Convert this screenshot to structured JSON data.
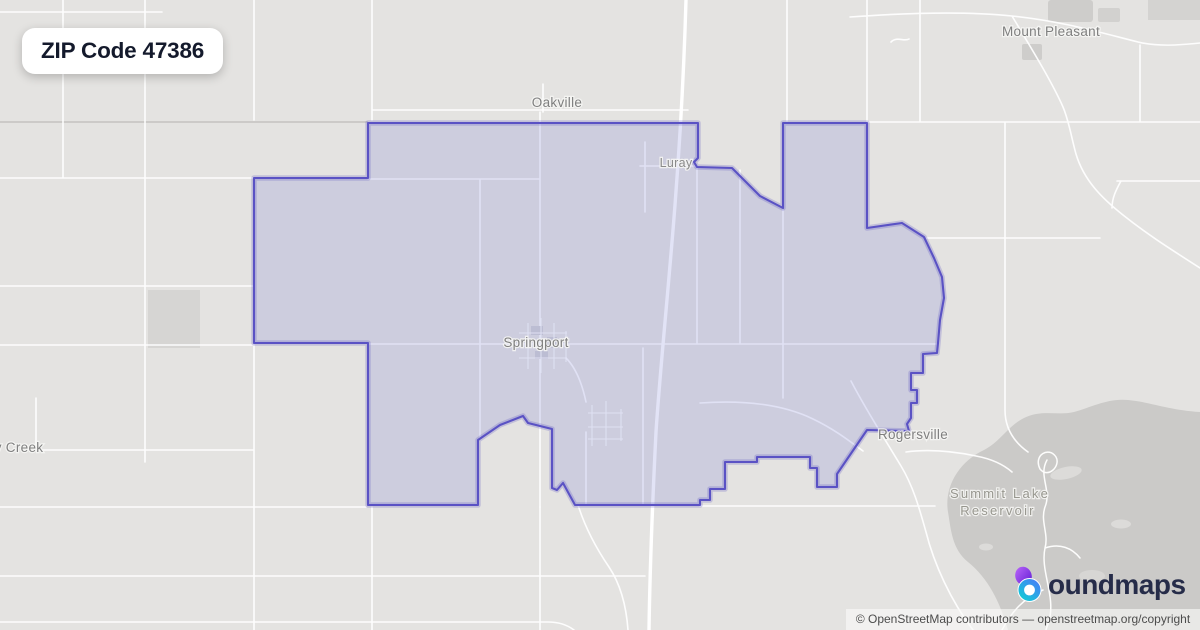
{
  "badge": {
    "label": "ZIP Code 47386"
  },
  "places": {
    "mount_pleasant": "Mount Pleasant",
    "oakville": "Oakville",
    "luray": "Luray",
    "springport": "Springport",
    "rogersville": "Rogersville",
    "summit_lake_line1": "Summit Lake",
    "summit_lake_line2": "Reservoir",
    "creek_partial": "y Creek"
  },
  "branding": {
    "logo_text": "oundmaps"
  },
  "attribution": {
    "text": "© OpenStreetMap contributors — openstreetmap.org/copyright"
  },
  "colors": {
    "map_background": "#e4e3e1",
    "road": "#ffffff",
    "water": "#cbcac8",
    "zip_fill": "#7a80d8",
    "zip_stroke": "#5a52c4",
    "label_text": "#7f7f7f",
    "badge_text": "#141a2c",
    "logo_text": "#262c49",
    "logo_purple": "#8b3dec",
    "logo_cyan": "#19b8d6"
  }
}
